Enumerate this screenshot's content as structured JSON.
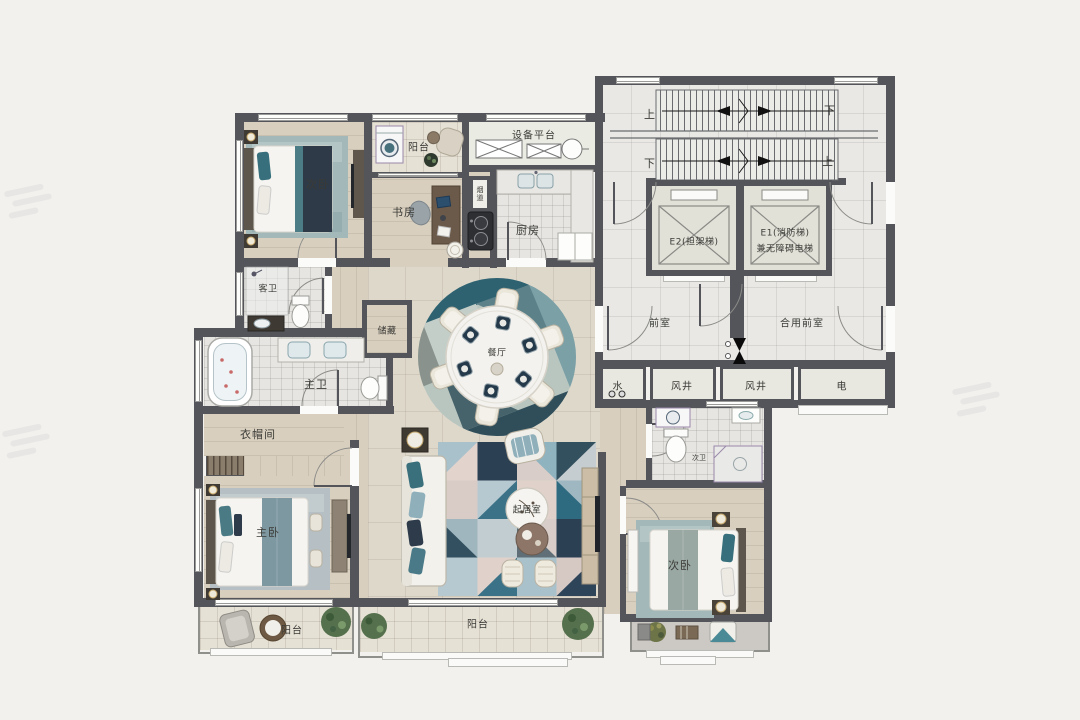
{
  "rooms": {
    "bedroom_top": "次卧",
    "balcony_top": "阳台",
    "equipment": "设备平台",
    "study": "书房",
    "flue": "烟道",
    "kitchen": "厨房",
    "guest_bath": "客卫",
    "storage": "储藏",
    "master_bath": "主卫",
    "cloak": "衣帽间",
    "master_bedroom": "主卧",
    "master_balcony": "阳台",
    "dining": "餐厅",
    "living": "起居室",
    "south_balcony": "阳台",
    "second_bath": "次卫",
    "bedroom_bottom": "次卧"
  },
  "core": {
    "front_room": "前室",
    "shared_front_room": "合用前室",
    "water": "水",
    "wind1": "风井",
    "wind2": "风井",
    "electric": "电",
    "e2": "E2(担架梯)",
    "e1a": "E1(消防梯)",
    "e1b": "兼无障碍电梯",
    "up_tl": "上",
    "down_tr": "下",
    "down_bl": "下",
    "up_br": "上"
  },
  "colors": {
    "wall": "#54555a",
    "accent_teal": "#38707d",
    "accent_navy": "#2d3b4a",
    "wood_floor": "#d8cfbf",
    "tile_floor": "#ded8cb"
  }
}
